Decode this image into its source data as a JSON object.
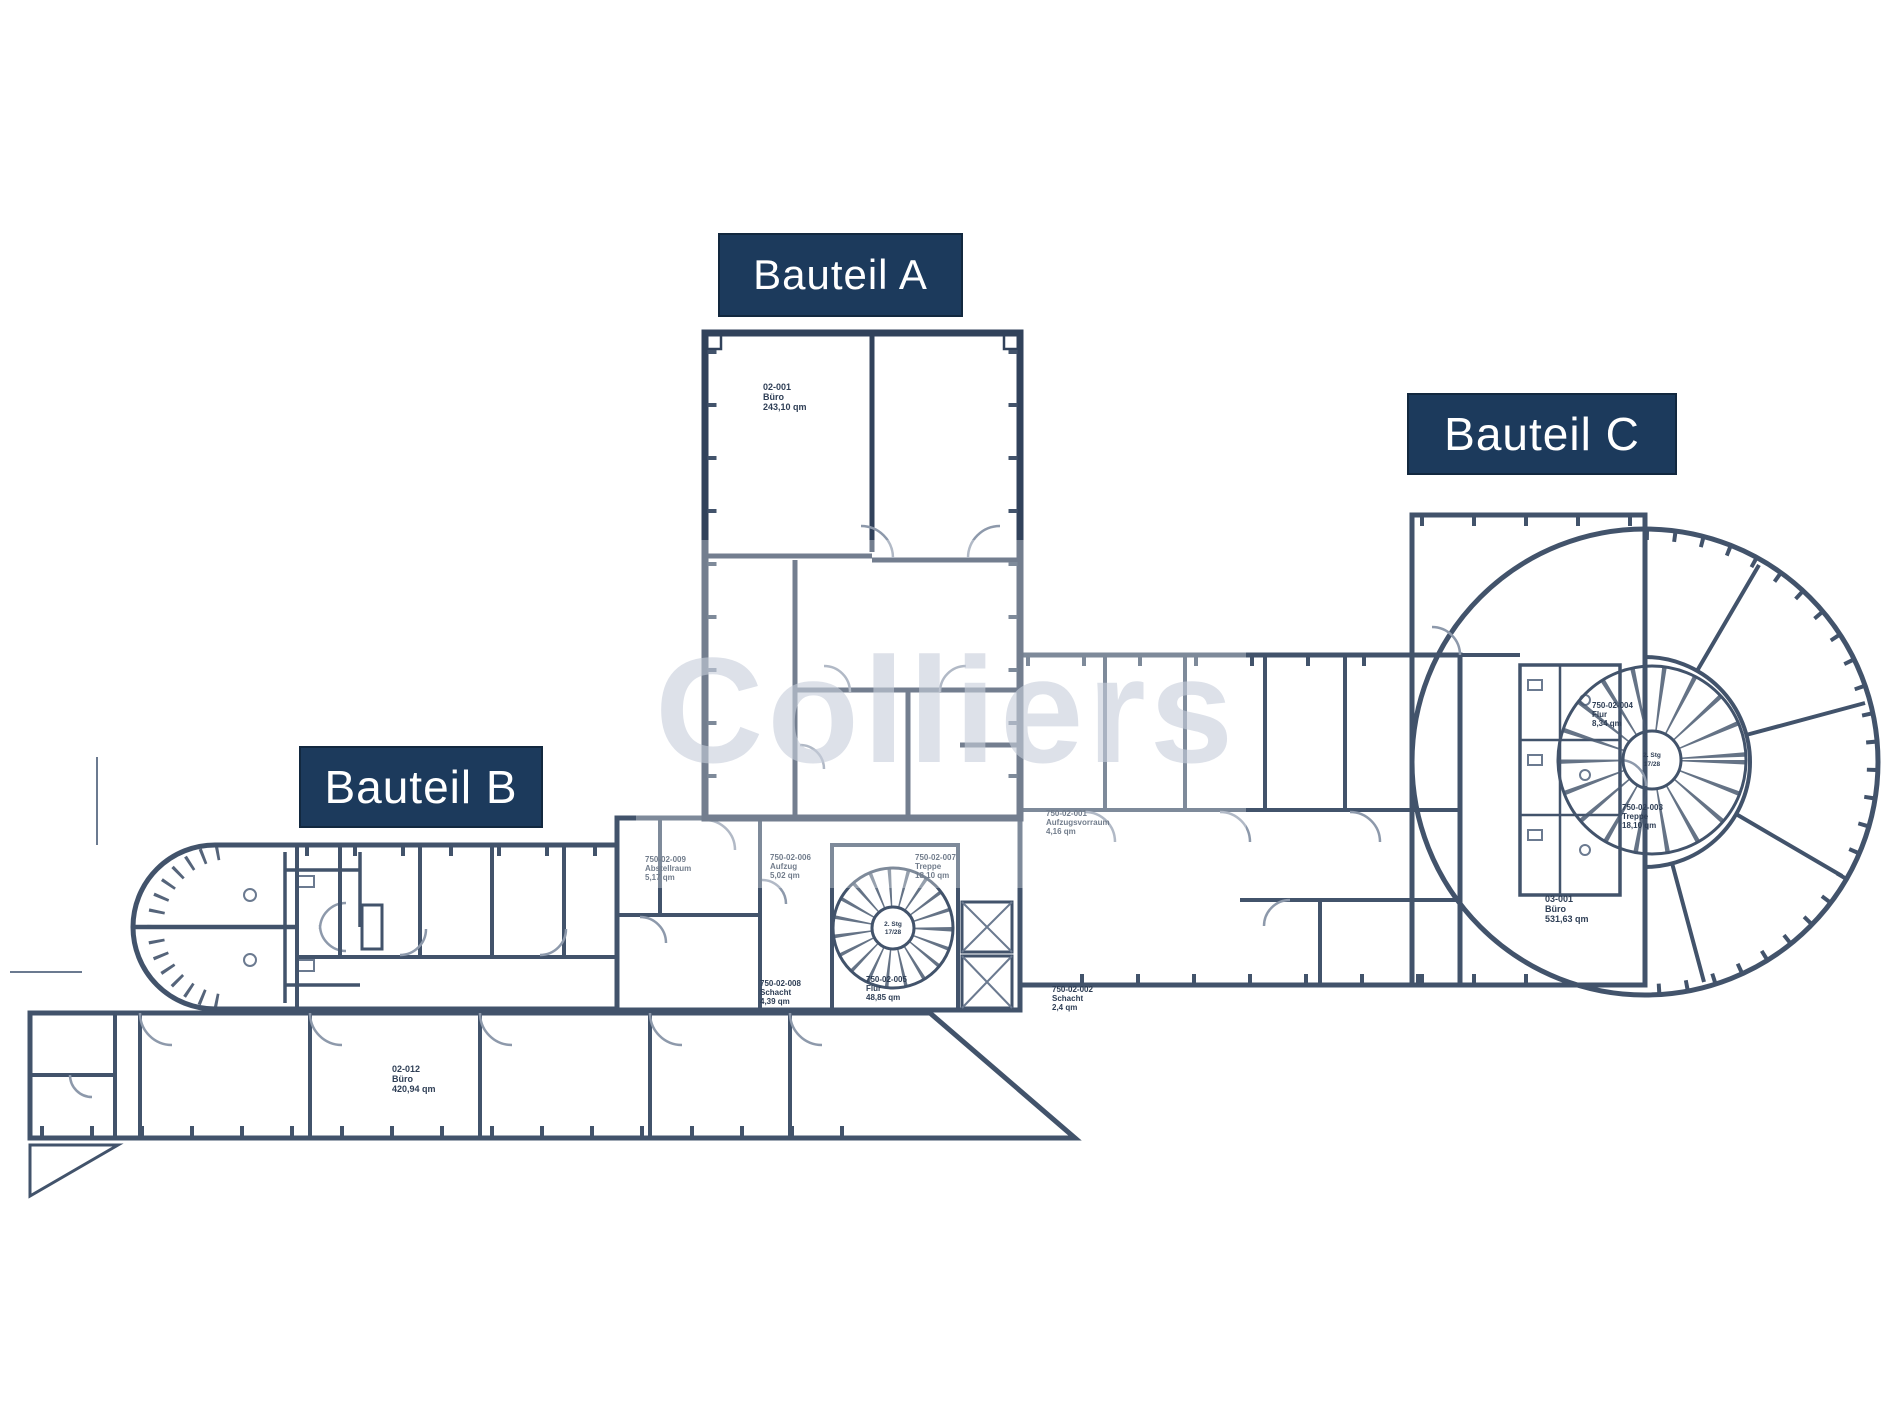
{
  "watermark": {
    "text": "Colliers",
    "color": "#c7cedb"
  },
  "building_labels": {
    "a": "Bauteil A",
    "b": "Bauteil B",
    "c": "Bauteil C"
  },
  "colors": {
    "label_background": "#1c3a5c",
    "label_text": "#ffffff",
    "wall_dark": "#31425b",
    "wall_mid": "#42536b",
    "fill_bauteil_a": "#f4f6f9",
    "fill_corridor": "#e2e6ed",
    "fill_bauteil_b": "#b5bfcd",
    "fill_bauteil_c": "#ced4dd"
  },
  "rooms": {
    "a_office": {
      "lines": [
        "02-001",
        "Büro",
        "243,10 qm"
      ]
    },
    "b_office": {
      "lines": [
        "02-012",
        "Büro",
        "420,94 qm"
      ]
    },
    "c_office": {
      "lines": [
        "03-001",
        "Büro",
        "531,63 qm"
      ]
    },
    "b_abstell": {
      "lines": [
        "750-02-009",
        "Abstellraum",
        "5,17 qm"
      ]
    },
    "b_stair_left": {
      "lines": [
        "750-02-006",
        "Aufzug",
        "5,02 qm"
      ]
    },
    "b_stair_right": {
      "lines": [
        "750-02-007",
        "Treppe",
        "18,10 qm"
      ]
    },
    "b_schacht": {
      "lines": [
        "750-02-008",
        "Schacht",
        "4,39 qm"
      ]
    },
    "b_flur": {
      "lines": [
        "750-02-005",
        "Flur",
        "48,85 qm"
      ]
    },
    "mid_flur": {
      "lines": [
        "750-02-001",
        "Aufzugsvorraum",
        "4,16 qm"
      ]
    },
    "mid_schacht": {
      "lines": [
        "750-02-002",
        "Schacht",
        "2,4 qm"
      ]
    },
    "c_flur": {
      "lines": [
        "750-02-004",
        "Flur",
        "8,34 qm"
      ]
    },
    "c_treppe": {
      "lines": [
        "750-02-003",
        "Treppe",
        "18,10 qm"
      ]
    },
    "b_stair_core": {
      "lines": [
        "2. Stg",
        "17/28"
      ]
    },
    "c_stair_core": {
      "lines": [
        "2. Stg",
        "17/28"
      ]
    }
  }
}
